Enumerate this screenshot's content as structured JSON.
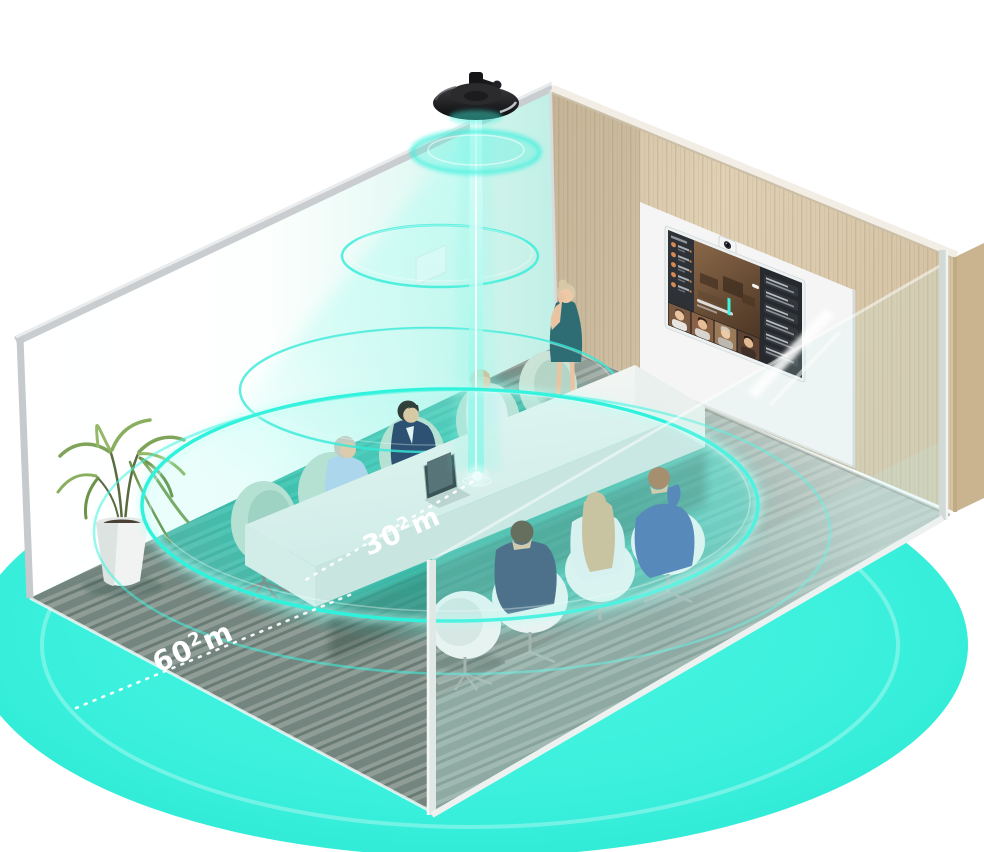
{
  "scene": {
    "title": "Conference room ceiling-microphone coverage illustration",
    "measurements": {
      "table_coverage": {
        "value": "30",
        "sup": "2",
        "unit": "m"
      },
      "room_coverage": {
        "value": "60",
        "sup": "2",
        "unit": "m"
      }
    },
    "colors": {
      "accent_teal": "#3ef2de",
      "ring_cyan": "#2ff0db",
      "beam_cyan": "#9df7ea",
      "carpet_green": "#8d9b94",
      "wood_wall": "#d9c8ab",
      "tv_screen_dark": "#22252a",
      "chair_mint": "#c6e0d4",
      "chair_white": "#eef3f2",
      "suit_navy": "#2c3f66",
      "suit_blue": "#3c5fa9",
      "dress_teal": "#2f6d74"
    },
    "objects": {
      "ceiling_microphone": "ceiling-microphone",
      "light_beam": "light-beam",
      "coverage_rings": 4,
      "display": "video-conference-display",
      "display_camera": "video-bar-camera",
      "laptop": "laptop",
      "plant": "potted-palm",
      "seated_people": 6,
      "standing_people": 1,
      "empty_chairs": 4
    }
  }
}
